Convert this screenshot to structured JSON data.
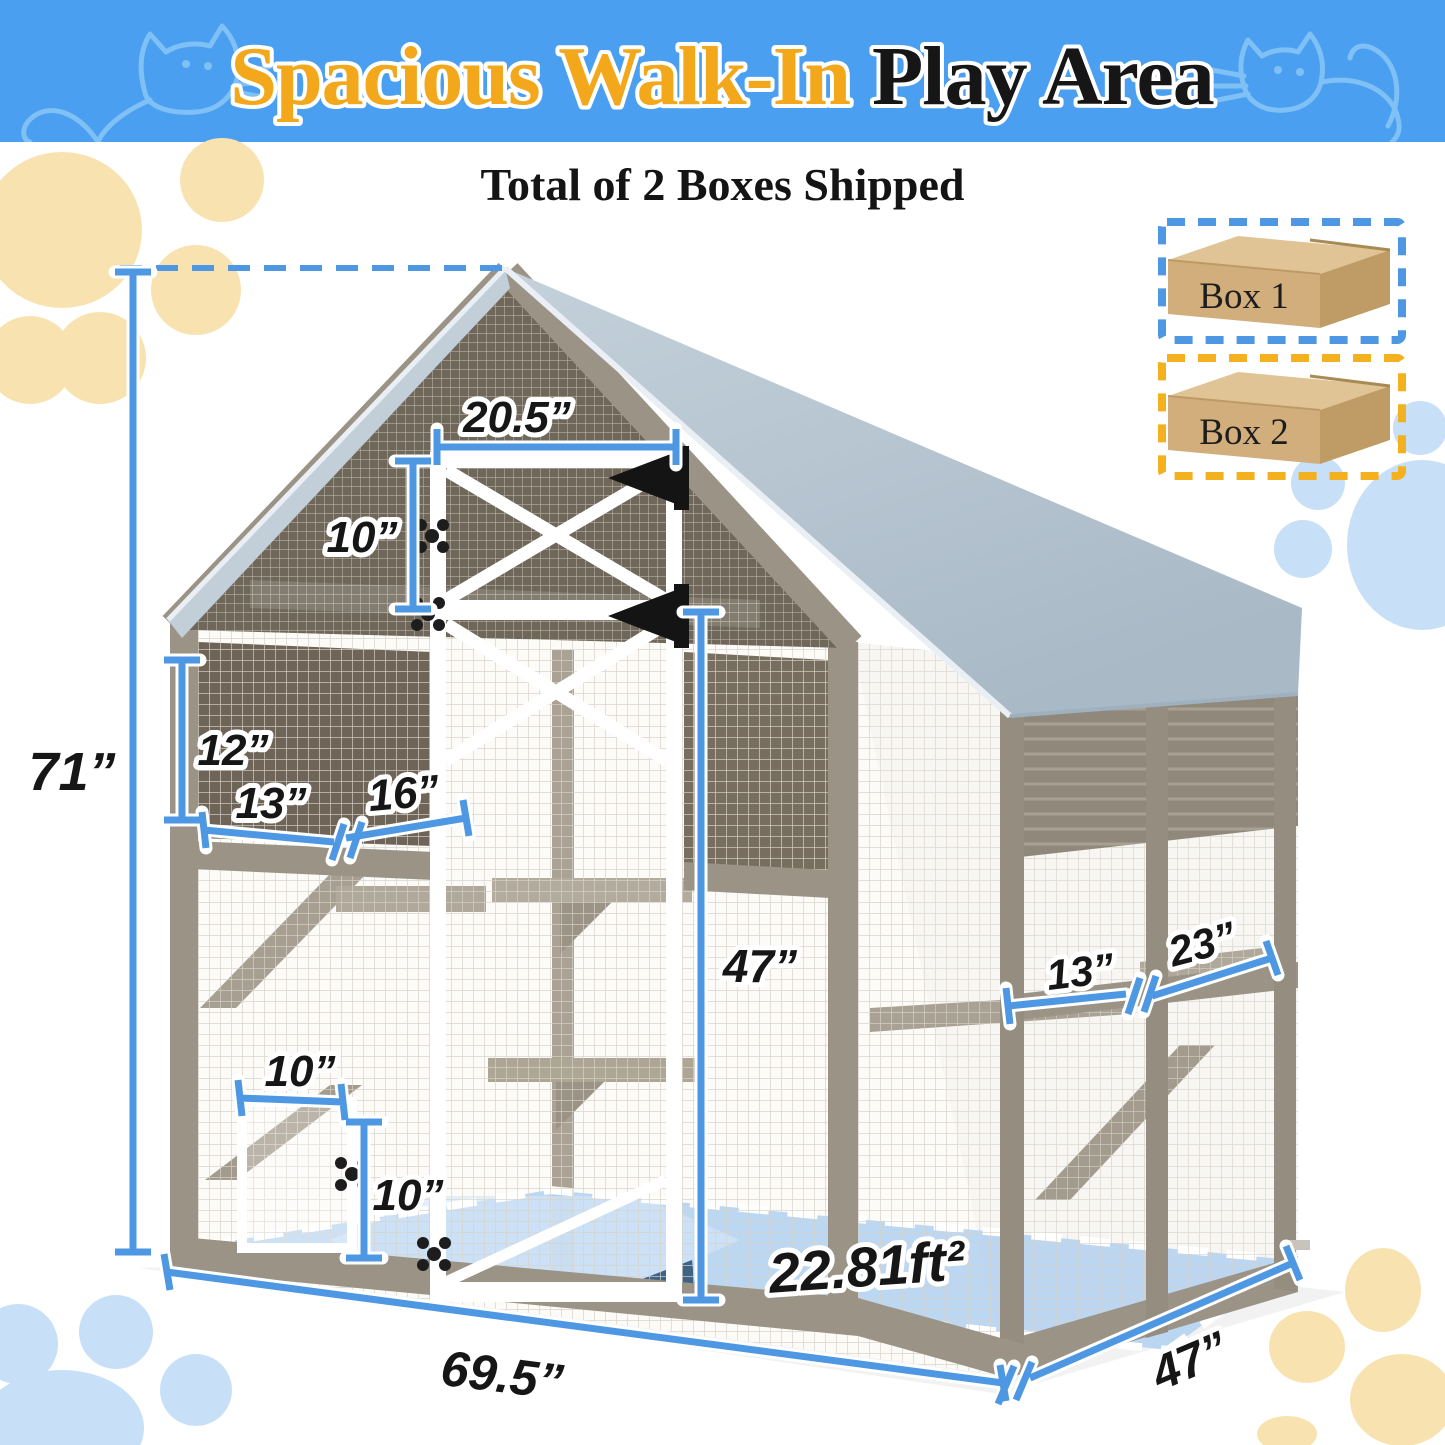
{
  "banner": {
    "title_highlight": "Spacious Walk-In",
    "title_rest": "Play Area"
  },
  "subtitle": "Total of 2 Boxes Shipped",
  "boxes": {
    "box1": "Box 1",
    "box2": "Box 2"
  },
  "dims": {
    "overall_height": "71”",
    "top_door_width": "20.5”",
    "top_door_height": "10”",
    "cabin_height": "12”",
    "cabin_width": "13”",
    "cabin_width2": "16”",
    "walk_door_height": "47”",
    "right_shelf": "13”",
    "right_shelf2": "23”",
    "pet_door_width": "10”",
    "pet_door_height": "10”",
    "floor_area": "22.81ft²",
    "overall_width": "69.5”",
    "overall_depth": "47”"
  },
  "colors": {
    "banner_blue": "#4a9ff0",
    "title_gold": "#f3a71a",
    "dimension_blue": "#4d97e3",
    "roof_gray": "#b3c1cd",
    "frame_taupe": "#9a9386",
    "floor_blue": "#b5d3f1",
    "box1_dash": "#4d97e3",
    "box2_dash": "#f3b11f",
    "paw_cream": "#f8e3b0",
    "paw_blue": "#c7e0f7"
  }
}
